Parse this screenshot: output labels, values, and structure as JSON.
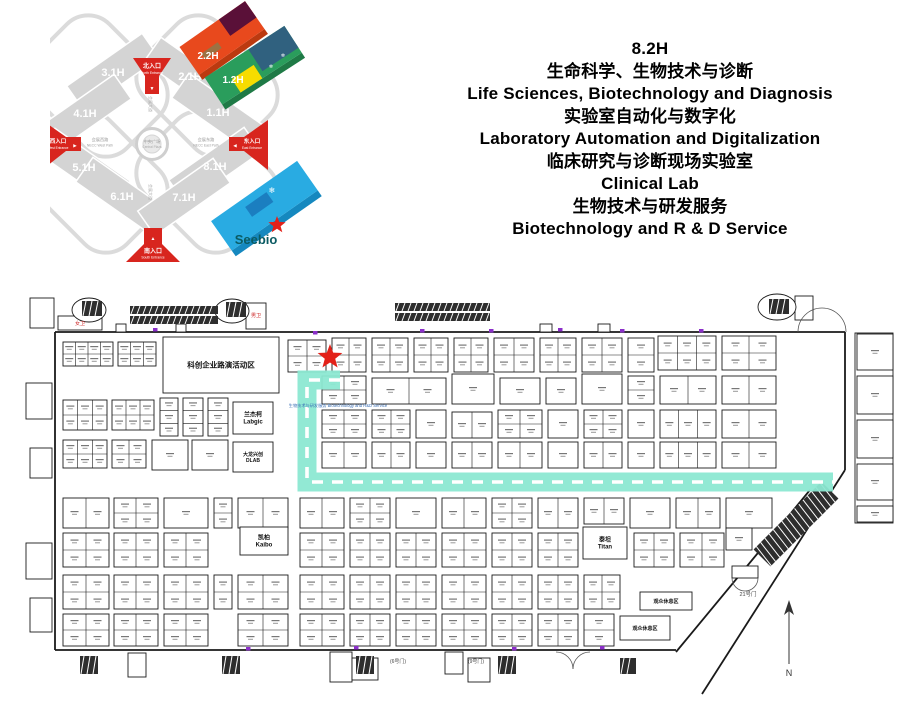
{
  "overview": {
    "halls": [
      "3.1H",
      "2.1H",
      "4.1H",
      "1.1H",
      "5.1H",
      "8.1H",
      "6.1H",
      "7.1H"
    ],
    "blocks": {
      "b22": "2.2H",
      "b12": "1.2H",
      "b82": "8.2H"
    },
    "brand": "Seebio",
    "entrances": {
      "north_zh": "北入口",
      "north_en": "North Entrance",
      "west_zh": "西入口",
      "west_en": "West Entrance",
      "east_zh": "东入口",
      "east_en": "East Entrance",
      "south_zh": "南入口",
      "south_en": "South Entrance"
    },
    "center_zh": "中央广场",
    "center_en": "Central Plaza",
    "roads": {
      "west_zh": "会展西路",
      "west_en": "NECC West Path",
      "east_zh": "会展东路",
      "east_en": "NECC East Path",
      "axis": "会展大道"
    },
    "colors": {
      "hall_gray": "#D4D4D4",
      "entrance_red": "#D8251E",
      "orange": "#E8491D",
      "maroon": "#5A1038",
      "green": "#2A9D5C",
      "yellow": "#F7DC00",
      "navy": "#30617F",
      "blue": "#29ABE2",
      "seebio_teal": "#0B5B63"
    }
  },
  "header": {
    "lines": [
      "8.2H",
      "生命科学、生物技术与诊断",
      "Life Sciences, Biotechnology and Diagnosis",
      "实验室自动化与数字化",
      "Laboratory Automation and Digitalization",
      "临床研究与诊断现场实验室",
      "Clinical Lab",
      "生物技术与研发服务",
      "Biotechnology and R & D Service"
    ]
  },
  "floorplan": {
    "route_color": "#8CE8D2",
    "star_color": "#E32119",
    "route_path": "M340,380 H307 V482 H833",
    "star_points": "330,344 333.2,352.6 342.4,353 335.2,358.7 337.6,367.5 330,362.5 322.4,367.5 324.8,358.7 317.6,353 326.8,352.6",
    "walls": [
      "M55,332 H845",
      "M55,332 V650",
      "M55,650 H676",
      "M845,332 V470",
      "M810,490 L676,652",
      "M845,470 L702,694"
    ],
    "arcs": [
      "M798,332 A24,24 0 0 1 822,308",
      "M846,332 A24,24 0 0 0 822,308",
      "M556,652 A17,17 0 0 1 573,669",
      "M590,652 A17,17 0 0 0 573,669",
      "M732,578 A13,13 0 0 0 745,591",
      "M758,578 A13,13 0 0 1 745,591"
    ],
    "rects": [
      [
        58,
        316,
        44,
        14
      ],
      [
        246,
        303,
        20,
        26
      ],
      [
        30,
        298,
        24,
        30
      ],
      [
        26,
        383,
        26,
        36
      ],
      [
        30,
        448,
        22,
        30
      ],
      [
        26,
        543,
        26,
        36
      ],
      [
        30,
        598,
        22,
        34
      ],
      [
        116,
        324,
        10,
        8
      ],
      [
        176,
        324,
        10,
        8
      ],
      [
        540,
        324,
        12,
        8
      ],
      [
        598,
        324,
        12,
        8
      ],
      [
        795,
        296,
        18,
        24
      ],
      [
        855,
        333,
        38,
        190
      ],
      [
        330,
        652,
        22,
        30
      ],
      [
        352,
        658,
        26,
        22
      ],
      [
        445,
        652,
        18,
        22
      ],
      [
        468,
        658,
        22,
        24
      ],
      [
        128,
        653,
        18,
        24
      ],
      [
        732,
        566,
        26,
        12
      ]
    ],
    "ovals": [
      [
        89,
        310,
        17,
        12
      ],
      [
        232,
        311,
        17,
        12
      ],
      [
        777,
        307,
        19,
        13
      ]
    ],
    "hatch": [
      [
        82,
        301,
        20,
        15,
        0
      ],
      [
        226,
        302,
        20,
        15,
        0
      ],
      [
        769,
        299,
        20,
        15,
        0
      ],
      [
        130,
        306,
        88,
        8,
        0
      ],
      [
        130,
        316,
        88,
        8,
        0
      ],
      [
        395,
        303,
        95,
        8,
        0
      ],
      [
        395,
        313,
        95,
        8,
        0
      ],
      [
        80,
        656,
        18,
        18,
        0
      ],
      [
        222,
        656,
        18,
        18,
        0
      ],
      [
        356,
        656,
        18,
        18,
        0
      ],
      [
        498,
        656,
        18,
        18,
        0
      ],
      [
        620,
        658,
        16,
        16,
        0
      ],
      [
        748,
        512,
        96,
        24,
        -45
      ]
    ],
    "ticks": [
      [
        153,
        328
      ],
      [
        420,
        329
      ],
      [
        489,
        329
      ],
      [
        558,
        328
      ],
      [
        620,
        329
      ],
      [
        699,
        329
      ],
      [
        246,
        647
      ],
      [
        354,
        646
      ],
      [
        512,
        647
      ],
      [
        600,
        646
      ],
      [
        313,
        331
      ]
    ],
    "tick_color": "#8B2FC9",
    "compass_line": "M789,608 V664",
    "compass_head": "789,600 794,615 789,611 784,615",
    "labels": [
      [
        "女卫",
        80,
        325,
        5,
        "#CC2222"
      ],
      [
        "男卫",
        256,
        317,
        5,
        "#CC2222"
      ],
      [
        "21号门",
        748,
        596,
        5.5,
        "#444"
      ],
      [
        "(6号门)",
        398,
        663,
        5,
        "#444"
      ],
      [
        "(9号门)",
        476,
        663,
        5,
        "#444"
      ],
      [
        "N",
        789,
        676,
        9,
        "#333"
      ],
      [
        "生物技术与研发服务 Biotechnology and R&D Service",
        338,
        407,
        4.2,
        "#3A6FB5"
      ]
    ],
    "booths": [
      [
        163,
        337,
        116,
        56,
        1,
        1,
        "科创企业路演活动区",
        7.5
      ],
      [
        63,
        342,
        50,
        24,
        4,
        2
      ],
      [
        118,
        342,
        38,
        24,
        3,
        2
      ],
      [
        288,
        340,
        38,
        32,
        2,
        2
      ],
      [
        332,
        338,
        34,
        34,
        2,
        2
      ],
      [
        372,
        338,
        36,
        34,
        2,
        2
      ],
      [
        414,
        338,
        34,
        34,
        2,
        2
      ],
      [
        454,
        338,
        34,
        34,
        2,
        2
      ],
      [
        494,
        338,
        40,
        34,
        2,
        2
      ],
      [
        540,
        338,
        36,
        34,
        2,
        2
      ],
      [
        582,
        338,
        40,
        34,
        2,
        2
      ],
      [
        628,
        338,
        26,
        34,
        1,
        2
      ],
      [
        658,
        336,
        58,
        34,
        3,
        2
      ],
      [
        722,
        336,
        54,
        34,
        2,
        2
      ],
      [
        63,
        400,
        44,
        30,
        3,
        2
      ],
      [
        112,
        400,
        42,
        30,
        3,
        2
      ],
      [
        160,
        398,
        18,
        38,
        1,
        3
      ],
      [
        183,
        398,
        20,
        38,
        1,
        3
      ],
      [
        208,
        398,
        20,
        38,
        1,
        3
      ],
      [
        233,
        402,
        40,
        32,
        1,
        1,
        "兰杰柯\nLabgic",
        6
      ],
      [
        63,
        440,
        44,
        28,
        3,
        2
      ],
      [
        112,
        440,
        34,
        28,
        2,
        2
      ],
      [
        152,
        440,
        36,
        30,
        1,
        1
      ],
      [
        192,
        440,
        36,
        30,
        1,
        1
      ],
      [
        233,
        442,
        40,
        30,
        1,
        1,
        "大龙兴创\nDLAB",
        5
      ],
      [
        322,
        376,
        44,
        28,
        2,
        2
      ],
      [
        372,
        378,
        74,
        26,
        2,
        1
      ],
      [
        452,
        374,
        42,
        30,
        1,
        1
      ],
      [
        500,
        378,
        40,
        26,
        1,
        1
      ],
      [
        546,
        378,
        30,
        26,
        1,
        1
      ],
      [
        582,
        374,
        40,
        30,
        1,
        1
      ],
      [
        628,
        376,
        26,
        28,
        1,
        2
      ],
      [
        660,
        376,
        56,
        28,
        2,
        1
      ],
      [
        722,
        376,
        54,
        28,
        2,
        1
      ],
      [
        322,
        410,
        44,
        28,
        2,
        2
      ],
      [
        372,
        410,
        38,
        28,
        2,
        2
      ],
      [
        416,
        410,
        30,
        28,
        1,
        1
      ],
      [
        452,
        412,
        40,
        26,
        2,
        1
      ],
      [
        498,
        410,
        44,
        28,
        2,
        2
      ],
      [
        548,
        410,
        30,
        28,
        1,
        1
      ],
      [
        584,
        410,
        38,
        28,
        2,
        2
      ],
      [
        628,
        410,
        26,
        28,
        1,
        1
      ],
      [
        660,
        410,
        56,
        28,
        3,
        1
      ],
      [
        722,
        410,
        54,
        28,
        2,
        1
      ],
      [
        322,
        442,
        44,
        26,
        2,
        1
      ],
      [
        372,
        442,
        38,
        26,
        2,
        1
      ],
      [
        416,
        442,
        30,
        26,
        1,
        1
      ],
      [
        452,
        442,
        40,
        26,
        2,
        1
      ],
      [
        498,
        442,
        44,
        26,
        2,
        1
      ],
      [
        548,
        442,
        30,
        26,
        1,
        1
      ],
      [
        584,
        442,
        38,
        26,
        2,
        1
      ],
      [
        628,
        442,
        26,
        26,
        1,
        1
      ],
      [
        660,
        442,
        56,
        26,
        3,
        1
      ],
      [
        722,
        442,
        54,
        26,
        2,
        1
      ],
      [
        63,
        498,
        46,
        30,
        2,
        1
      ],
      [
        114,
        498,
        44,
        30,
        2,
        2
      ],
      [
        164,
        498,
        44,
        30,
        1,
        1
      ],
      [
        214,
        498,
        18,
        30,
        1,
        2
      ],
      [
        238,
        498,
        50,
        30,
        2,
        1
      ],
      [
        300,
        498,
        44,
        30,
        2,
        1
      ],
      [
        350,
        498,
        40,
        30,
        2,
        2
      ],
      [
        396,
        498,
        40,
        30,
        1,
        1
      ],
      [
        442,
        498,
        44,
        30,
        2,
        1
      ],
      [
        492,
        498,
        40,
        30,
        2,
        2
      ],
      [
        538,
        498,
        40,
        30,
        2,
        1
      ],
      [
        584,
        498,
        40,
        26,
        2,
        1
      ],
      [
        630,
        498,
        40,
        30,
        1,
        1
      ],
      [
        676,
        498,
        44,
        30,
        2,
        1
      ],
      [
        726,
        498,
        46,
        30,
        1,
        1
      ],
      [
        63,
        533,
        46,
        34,
        2,
        2
      ],
      [
        114,
        533,
        44,
        34,
        2,
        2
      ],
      [
        164,
        533,
        44,
        34,
        2,
        2
      ],
      [
        240,
        527,
        48,
        28,
        1,
        1,
        "凯柏\nKaibo",
        6
      ],
      [
        300,
        533,
        44,
        34,
        2,
        2
      ],
      [
        350,
        533,
        40,
        34,
        2,
        2
      ],
      [
        396,
        533,
        40,
        34,
        2,
        2
      ],
      [
        442,
        533,
        44,
        34,
        2,
        2
      ],
      [
        492,
        533,
        40,
        34,
        2,
        2
      ],
      [
        538,
        533,
        40,
        34,
        2,
        2
      ],
      [
        583,
        527,
        44,
        32,
        1,
        1,
        "泰坦\nTitan",
        6
      ],
      [
        634,
        533,
        40,
        34,
        2,
        2
      ],
      [
        680,
        533,
        44,
        34,
        2,
        2
      ],
      [
        726,
        528,
        26,
        22,
        1,
        1
      ],
      [
        63,
        575,
        46,
        34,
        2,
        2
      ],
      [
        114,
        575,
        44,
        34,
        2,
        2
      ],
      [
        164,
        575,
        44,
        34,
        2,
        2
      ],
      [
        214,
        575,
        18,
        34,
        1,
        2
      ],
      [
        238,
        575,
        50,
        34,
        2,
        2
      ],
      [
        300,
        575,
        44,
        34,
        2,
        2
      ],
      [
        350,
        575,
        40,
        34,
        2,
        2
      ],
      [
        396,
        575,
        40,
        34,
        2,
        2
      ],
      [
        442,
        575,
        44,
        34,
        2,
        2
      ],
      [
        492,
        575,
        40,
        34,
        2,
        2
      ],
      [
        538,
        575,
        40,
        34,
        2,
        2
      ],
      [
        584,
        575,
        36,
        34,
        2,
        2
      ],
      [
        640,
        592,
        52,
        18,
        1,
        1,
        "观众休息区",
        5
      ],
      [
        63,
        614,
        46,
        32,
        2,
        2
      ],
      [
        114,
        614,
        44,
        32,
        2,
        2
      ],
      [
        164,
        614,
        44,
        32,
        2,
        2
      ],
      [
        238,
        614,
        50,
        32,
        2,
        2
      ],
      [
        300,
        614,
        44,
        32,
        2,
        2
      ],
      [
        350,
        614,
        40,
        32,
        2,
        2
      ],
      [
        396,
        614,
        40,
        32,
        2,
        2
      ],
      [
        442,
        614,
        44,
        32,
        2,
        2
      ],
      [
        492,
        614,
        40,
        32,
        2,
        2
      ],
      [
        538,
        614,
        40,
        32,
        2,
        2
      ],
      [
        584,
        614,
        30,
        32,
        1,
        2
      ],
      [
        620,
        616,
        50,
        24,
        1,
        1,
        "观众休息区",
        5
      ],
      [
        857,
        334,
        36,
        36,
        1,
        1
      ],
      [
        857,
        376,
        36,
        38,
        1,
        1
      ],
      [
        857,
        420,
        36,
        38,
        1,
        1
      ],
      [
        857,
        464,
        36,
        36,
        1,
        1
      ],
      [
        857,
        506,
        36,
        16,
        1,
        1
      ]
    ]
  }
}
